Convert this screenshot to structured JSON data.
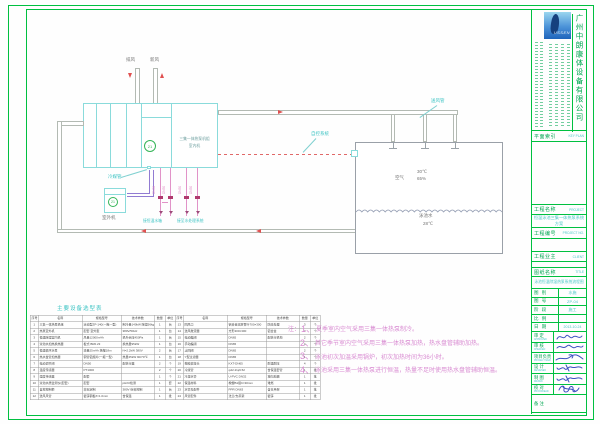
{
  "title_block": {
    "logo_text": "USSEN",
    "company_name": "广州中朗康体设备有限公司",
    "key_plan": {
      "label": "平面索引",
      "en": "KEY PLAN"
    },
    "rows": [
      {
        "label": "工程名称",
        "en": "PROJECT",
        "value": "恒温泳池三集一体热泵系统方案"
      },
      {
        "label": "工程编号",
        "en": "PROJECT NO.",
        "value": ""
      },
      {
        "label": "工程业主",
        "en": "CLIENT",
        "value": ""
      },
      {
        "label": "图纸名称",
        "en": "TITLE",
        "value": "泳池恒温除湿热泵系统流程图"
      }
    ],
    "info_rows": [
      {
        "label": "图 别",
        "value": "水施"
      },
      {
        "label": "图 号",
        "value": "ZP-04"
      },
      {
        "label": "阶 段",
        "value": "施工"
      },
      {
        "label": "比 例",
        "value": ""
      },
      {
        "label": "日 期",
        "value": "2013-10-24"
      }
    ],
    "sign_rows": [
      {
        "label": "审 定",
        "en": "APPROVED"
      },
      {
        "label": "审 核",
        "en": "CHECKED"
      },
      {
        "label": "项目负责",
        "en": "PROJECT MGR"
      },
      {
        "label": "设 计",
        "en": "DESIGNED"
      },
      {
        "label": "制 图",
        "en": "DRAWN"
      },
      {
        "label": "校 对",
        "en": "PROOFREAD"
      }
    ],
    "remark_label": "备 注"
  },
  "diagram": {
    "exhaust_label": "排风",
    "fresh_label": "新风",
    "ahu_label_line1": "三集一体热泵机组",
    "ahu_label_line2": "室内机",
    "ahu_tag": "21",
    "outdoor_tag": "21",
    "outdoor_label": "室外机",
    "refrigerant_label": "冷媒管",
    "supply_duct_label": "送风管",
    "control_label": "自控系统",
    "pool_air_label": "空气",
    "pool_air_temp": "30℃",
    "pool_air_rh": "65%",
    "pool_water_label": "泳池水",
    "pool_water_temp": "28℃",
    "pipe_size_label": "DN50",
    "pipe_left_label": "接恒温水箱",
    "pipe_right_label": "接至水处理系统"
  },
  "equipment_table": {
    "title": "主要设备选型表",
    "headers": [
      "序号",
      "名称",
      "规格型号",
      "技术参数",
      "数量",
      "单位"
    ],
    "left_rows": [
      [
        "1",
        "三集一体热泵机组",
        "泳池型ZP-140(一拖一型)",
        "制冷量140kW 除湿56kg/h",
        "1",
        "台"
      ],
      [
        "2",
        "热泵室外机",
        "配套 室外型",
        "380V/50Hz",
        "1",
        "台"
      ],
      [
        "3",
        "恒温除湿室内机",
        "风量12000m³/h",
        "机外余压450Pa",
        "1",
        "台"
      ],
      [
        "4",
        "泳池水加热换热器",
        "板式 BR0.23",
        "换热量95kW",
        "1",
        "台"
      ],
      [
        "5",
        "恒温循环水泵",
        "流量25m³/h 扬程18m",
        "N=2.2kW 380V",
        "2",
        "台"
      ],
      [
        "6",
        "热水盘管加热器",
        "铜管铝翅片(一拖一型)",
        "热量45kW 90/70℃",
        "1",
        "台"
      ],
      [
        "7",
        "电动调节阀",
        "DN50",
        "配执行器",
        "2",
        "个"
      ],
      [
        "8",
        "温度传感器",
        "PT1000",
        "",
        "2",
        "个"
      ],
      [
        "9",
        "湿度传感器",
        "配套",
        "",
        "1",
        "个"
      ],
      [
        "10",
        "泳池水质监测仪(配套)",
        "配套",
        "pH/Cl检测",
        "1",
        "套"
      ],
      [
        "11",
        "自控控制柜",
        "非标定制",
        "380V 综合控制",
        "1",
        "台"
      ],
      [
        "12",
        "送风风管",
        "镀锌钢板δ=1.0mm",
        "含保温",
        "1",
        "批"
      ]
    ],
    "right_rows": [
      [
        "13",
        "回风口",
        "铝合金双层百叶700×300",
        "防腐处理",
        "3",
        "个"
      ],
      [
        "14",
        "送风散流器",
        "方形300×300",
        "铝合金",
        "3",
        "个"
      ],
      [
        "15",
        "电动蝶阀",
        "DN65",
        "配执行机构",
        "2",
        "个"
      ],
      [
        "16",
        "手动蝶阀",
        "DN65",
        "",
        "4",
        "个"
      ],
      [
        "17",
        "止回阀",
        "DN65",
        "",
        "2",
        "个"
      ],
      [
        "18",
        "Y型过滤器",
        "DN65",
        "",
        "1",
        "个"
      ],
      [
        "19",
        "橡胶软接头",
        "KXT-DN65",
        "耐温耐压",
        "4",
        "个"
      ],
      [
        "20",
        "冷媒管",
        "φ22.2/φ9.52",
        "含保温套管",
        "1",
        "批"
      ],
      [
        "21",
        "冷凝水管",
        "U-PVC DN32",
        "坡向地漏",
        "1",
        "批"
      ],
      [
        "22",
        "保温材料",
        "橡塑B1级δ=30mm",
        "难燃",
        "1",
        "批"
      ],
      [
        "23",
        "水管及配件",
        "PPR DN63",
        "含支吊架",
        "1",
        "批"
      ],
      [
        "24",
        "风管配件",
        "法兰/支吊架",
        "镀锌",
        "1",
        "批"
      ]
    ]
  },
  "notes": {
    "prefix": "注：",
    "items": [
      {
        "num": "1",
        "text": "夏季室内空气采用三集一体热泵制冷。"
      },
      {
        "num": "2",
        "text": "其它季节室内空气采用三集一体热泵加热，热水盘管辅助加热。"
      },
      {
        "num": "3",
        "text": "泳池初次加温采用锅炉，初次加热时间为36小时。"
      },
      {
        "num": "4",
        "text": "泳池采用三集一体热泵进行恒温，热量不足时使用热水盘管辅助恒温。"
      }
    ]
  },
  "colors": {
    "frame_green": "#00c040",
    "text_green": "#00a651",
    "cad_cyan": "#49c6c6",
    "note_magenta": "#d98cd2",
    "pipe_pink": "#e193c8",
    "refrigerant_purple": "#917bd2",
    "arrow_red": "#e05050",
    "logo_blue": "#2b72c8",
    "signature_blue": "#3b4fc0"
  }
}
